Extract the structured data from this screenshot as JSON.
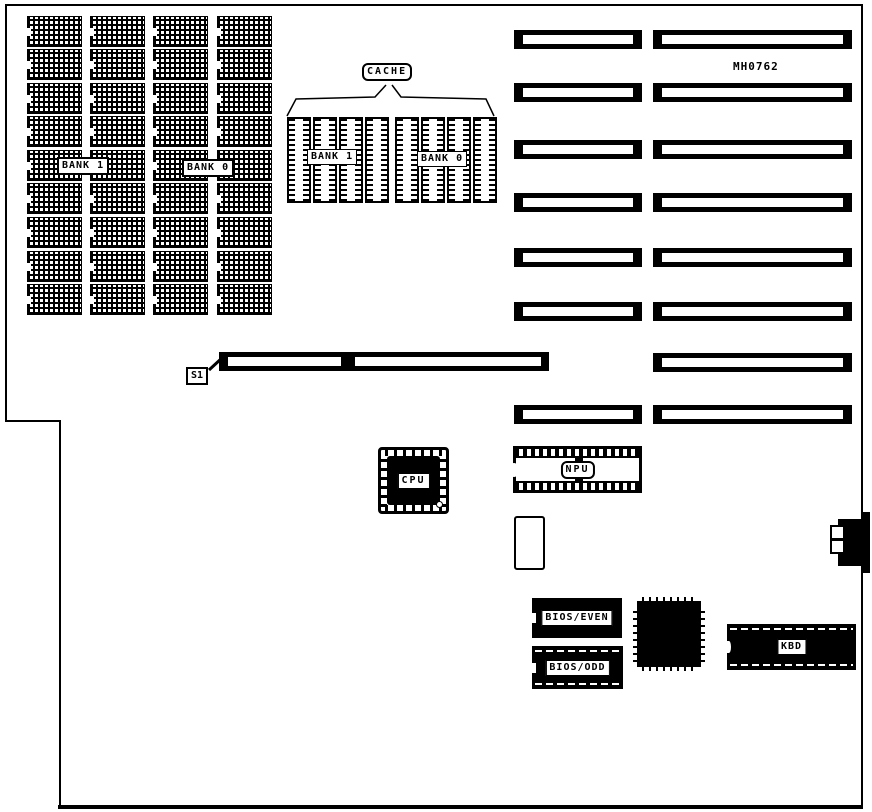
{
  "diagram": {
    "part_number": "MH0762",
    "memory": {
      "columns": 4,
      "chips_per_column": 9,
      "bank1_label": "BANK 1",
      "bank0_label": "BANK 0"
    },
    "cache": {
      "label": "CACHE",
      "groups": 2,
      "chips_per_group": 4,
      "bank1_label": "BANK 1",
      "bank0_label": "BANK 0"
    },
    "slots": {
      "rows": 8,
      "s1_row_index": 6,
      "s1_label": "S1"
    },
    "components": {
      "cpu_label": "CPU",
      "npu_label": "NPU",
      "bios_even_label": "BIOS/EVEN",
      "bios_odd_label": "BIOS/ODD",
      "kbd_label": "KBD"
    },
    "colors": {
      "ink": "#000000",
      "paper": "#ffffff"
    }
  }
}
